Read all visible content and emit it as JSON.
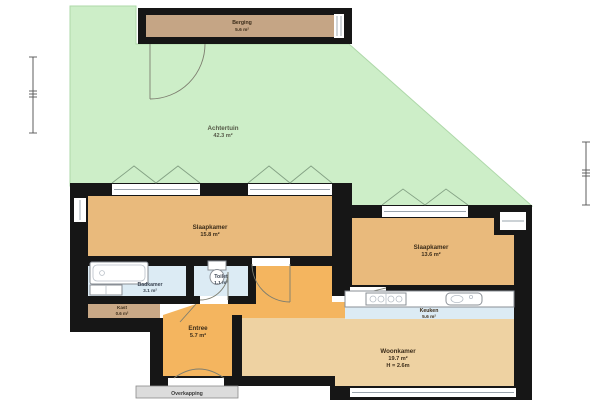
{
  "colors": {
    "garden": "#cdeec8",
    "garden_border": "#aed8a9",
    "wall": "#161616",
    "bedroom": "#e9ba7c",
    "living": "#eed2a2",
    "hall": "#f4b55f",
    "wet": "#dcebf4",
    "storage": "#c5a585",
    "kast": "#c9a886",
    "canopy": "#dcdcdc",
    "fixture_stroke": "#8a8f96",
    "tent": "#84a184",
    "label_dark": "#3c2d1a",
    "label_wet": "#3c4654",
    "label_garden": "#565a48"
  },
  "garden": {
    "name": "Achtertuin",
    "area": "42.3 m²"
  },
  "rooms": {
    "berging": {
      "name": "Berging",
      "area": "5.6 m²"
    },
    "slaapkamer_1": {
      "name": "Slaapkamer",
      "area": "15.8 m²"
    },
    "slaapkamer_2": {
      "name": "Slaapkamer",
      "area": "13.6 m²"
    },
    "badkamer": {
      "name": "Badkamer",
      "area": "3.1 m²"
    },
    "toilet": {
      "name": "Toilet",
      "area": "1.1 m²"
    },
    "kast": {
      "name": "Kast",
      "area": "0.6 m²"
    },
    "entree": {
      "name": "Entree",
      "area": "5.7 m²"
    },
    "keuken": {
      "name": "Keuken",
      "area": "5.6 m²"
    },
    "woonkamer": {
      "name": "Woonkamer",
      "area": "19.7 m²",
      "ceiling_height": "H = 2.6m"
    },
    "overkapping": {
      "name": "Overkapping"
    }
  }
}
